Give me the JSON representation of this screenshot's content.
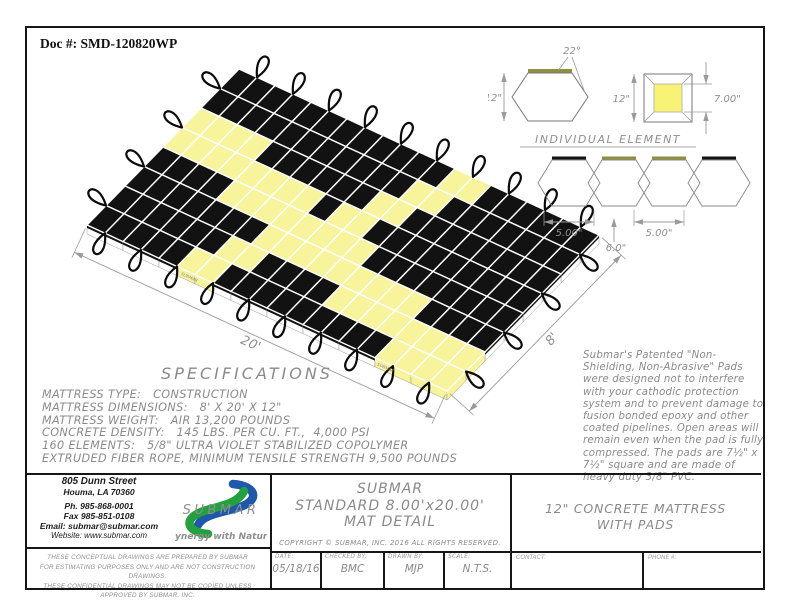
{
  "doc_number": "Doc #: SMD-120820WP",
  "colors": {
    "mat_yellow": "#F7F49B",
    "mat_black": "#121212",
    "pad_olive": "#8F8F3F",
    "line_gray": "#9A9A9A",
    "logo_blue": "#1F57AB",
    "logo_green": "#23A13F",
    "tagline_green": "#1C8A34"
  },
  "mat": {
    "pattern": [
      "BBBBBBBBBBBBYYBBBBBB",
      "BBBBBBBBBBBYYBBBBBBB",
      "YYYYBBBBBBYYBBBBBBBB",
      "YYYYYYYYBYYBBBBBBBBB",
      "BBBBYYYYYYYYBBBBBBBB",
      "BBBBBBBYYYYYYYYYBBBB",
      "BBBBBBYYBBBBYYYYYYYY",
      "BBBBBYYBBBBBBBBBYYYY"
    ],
    "dim_length": "20'",
    "dim_width": "8'",
    "edge_text": "SUBMAR"
  },
  "element_detail": {
    "title": "INDIVIDUAL ELEMENT",
    "angle": "22°",
    "side_height": "12\"",
    "plan_height": "12\"",
    "pad_size": "7.00\"",
    "spacing_left": "5.00\"",
    "spacing_center": "6.0\"",
    "spacing_right": "5.00\""
  },
  "specifications": {
    "title": "SPECIFICATIONS",
    "lines": [
      "MATTRESS TYPE:   CONSTRUCTION",
      "MATTRESS DIMENSIONS:   8' X 20' X 12\"",
      "MATTRESS WEIGHT:   AIR 13,200 POUNDS",
      "CONCRETE DENSITY:   145 LBS. PER CU. FT.,  4,000 PSI",
      "160 ELEMENTS:   5/8\" ULTRA VIOLET STABILIZED COPOLYMER",
      "EXTRUDED FIBER ROPE, MINIMUM TENSILE STRENGTH 9,500 POUNDS"
    ]
  },
  "pads_note": "Submar's Patented \"Non-Shielding, Non-Abrasive\" Pads were designed not to interfere with your cathodic protection system and to prevent damage to fusion bonded epoxy and other coated pipelines. Open areas will remain even when the pad is fully compressed. The pads are 7½\" x 7½\" square and are made of heavy duty 3/8\" PVC.",
  "title_block": {
    "company": {
      "address_line1": "805 Dunn Street",
      "address_line2": "Houma, LA 70360",
      "phone": "Ph. 985-868-0001",
      "fax": "Fax 985-851-0108",
      "email": "Email: submar@submar.com",
      "website": "Website: www.submar.com",
      "logo_text": "SUBMAR",
      "tagline": "Synergy with Nature"
    },
    "disclaimer": [
      "THESE CONCEPTUAL DRAWINGS ARE PREPARED BY SUBMAR",
      "FOR ESTIMATING PURPOSES ONLY AND ARE NOT CONSTRUCTION DRAWINGS.",
      "THESE CONFIDENTIAL DRAWINGS MAY NOT BE COPIED UNLESS APPROVED BY SUBMAR, INC."
    ],
    "title_lines": [
      "SUBMAR",
      "STANDARD  8.00'x20.00'",
      "MAT  DETAIL"
    ],
    "copyright": "COPYRIGHT © SUBMAR, INC. 2016 ALL RIGHTS RESERVED.",
    "fields": [
      {
        "label": "DATE:",
        "value": "05/18/16"
      },
      {
        "label": "CHECKED BY:",
        "value": "BMC"
      },
      {
        "label": "DRAWN BY:",
        "value": "MJP"
      },
      {
        "label": "SCALE:",
        "value": "N.T.S."
      }
    ],
    "contact_label": "CONTACT:",
    "phone_label": "PHONE #:",
    "description_line1": "12\"  CONCRETE  MATTRESS",
    "description_line2": "WITH  PADS"
  }
}
